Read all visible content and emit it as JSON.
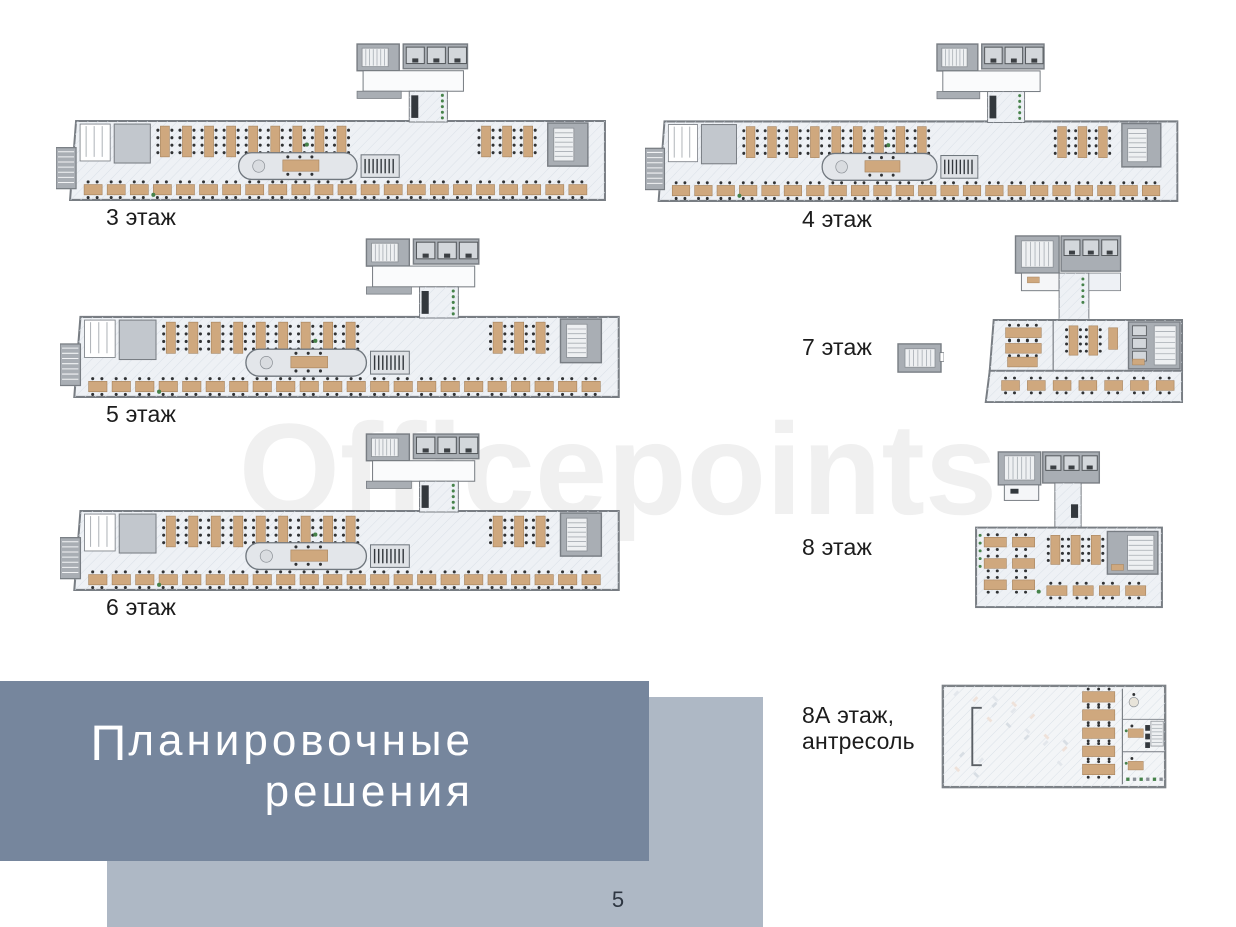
{
  "watermark": "Officepoints",
  "page_number": "5",
  "title": {
    "initial": "П",
    "line1_rest": "ланировочные",
    "line2": "решения"
  },
  "floors": [
    {
      "label": "3 этаж"
    },
    {
      "label": "4 этаж"
    },
    {
      "label": "5 этаж"
    },
    {
      "label": "6 этаж"
    },
    {
      "label": "7 этаж"
    },
    {
      "label": "8 этаж"
    },
    {
      "label": "8А этаж,",
      "label2": "антресоль"
    }
  ],
  "colors": {
    "title_box": "#76869d",
    "accent_box": "#aeb8c5",
    "watermark": "#f0f0f0",
    "page_number": "#2e3642",
    "label_color": "#1c1c1c",
    "plan_wall": "#787d83",
    "plan_core": "#a9aeb4",
    "plan_floor": "#eef1f5",
    "plan_hatch": "#d9e0e7",
    "desk": "#cfa87e",
    "desk_stroke": "#a5825c",
    "chair": "#303234",
    "plant": "#46824a",
    "dark_furniture": "#33383d"
  }
}
